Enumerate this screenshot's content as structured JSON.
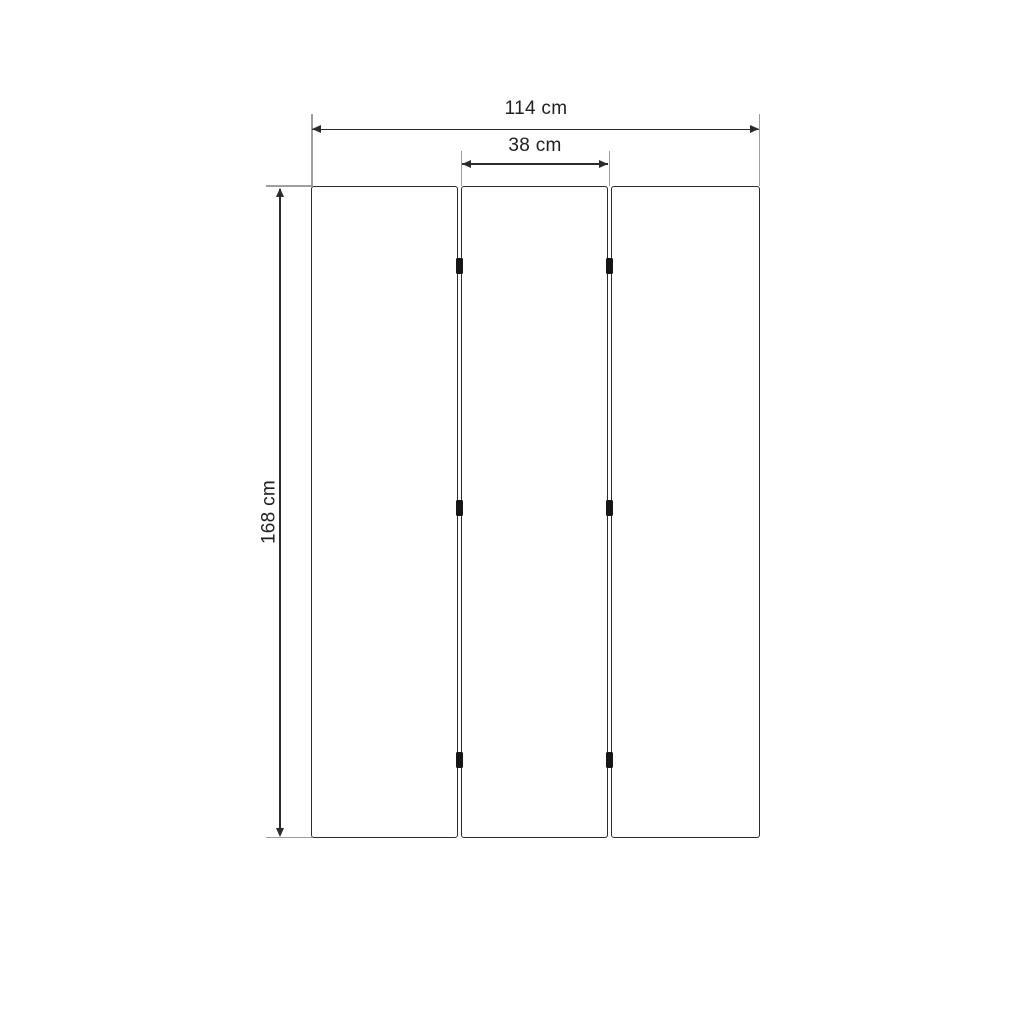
{
  "drawing": {
    "unit": "cm",
    "dimensions": {
      "total_width": {
        "label": "114 cm",
        "value": 114
      },
      "panel_width": {
        "label": "38 cm",
        "value": 38
      },
      "height": {
        "label": "168 cm",
        "value": 168
      }
    },
    "panels": {
      "count": 3
    },
    "hinges": {
      "count": 6,
      "rows": 3,
      "columns": 2
    },
    "colors": {
      "background": "#ffffff",
      "outline": "#2b2b2b",
      "extension_line": "#9e9e9e",
      "hinge": "#161616",
      "text": "#212121"
    }
  }
}
